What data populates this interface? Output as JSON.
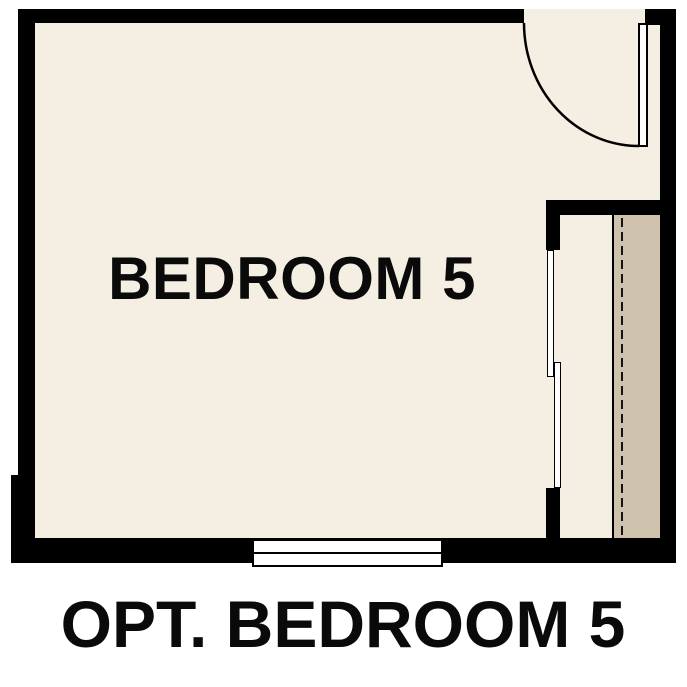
{
  "plan": {
    "room_label": "BEDROOM 5",
    "caption": "OPT. BEDROOM 5"
  },
  "colors": {
    "wall": "#000000",
    "line": "#000000",
    "floor": "#f5eee2",
    "shelf": "#cfc2ac",
    "background": "#ffffff",
    "text": "#0a0a0a"
  },
  "symbols": {
    "door": "door-swing-arc",
    "window": "double-pane-window",
    "closet_doors": "bypass-sliding-doors",
    "closet_rod": "dashed-closet-rod",
    "closet_shelf": "closet-shelf-band"
  }
}
